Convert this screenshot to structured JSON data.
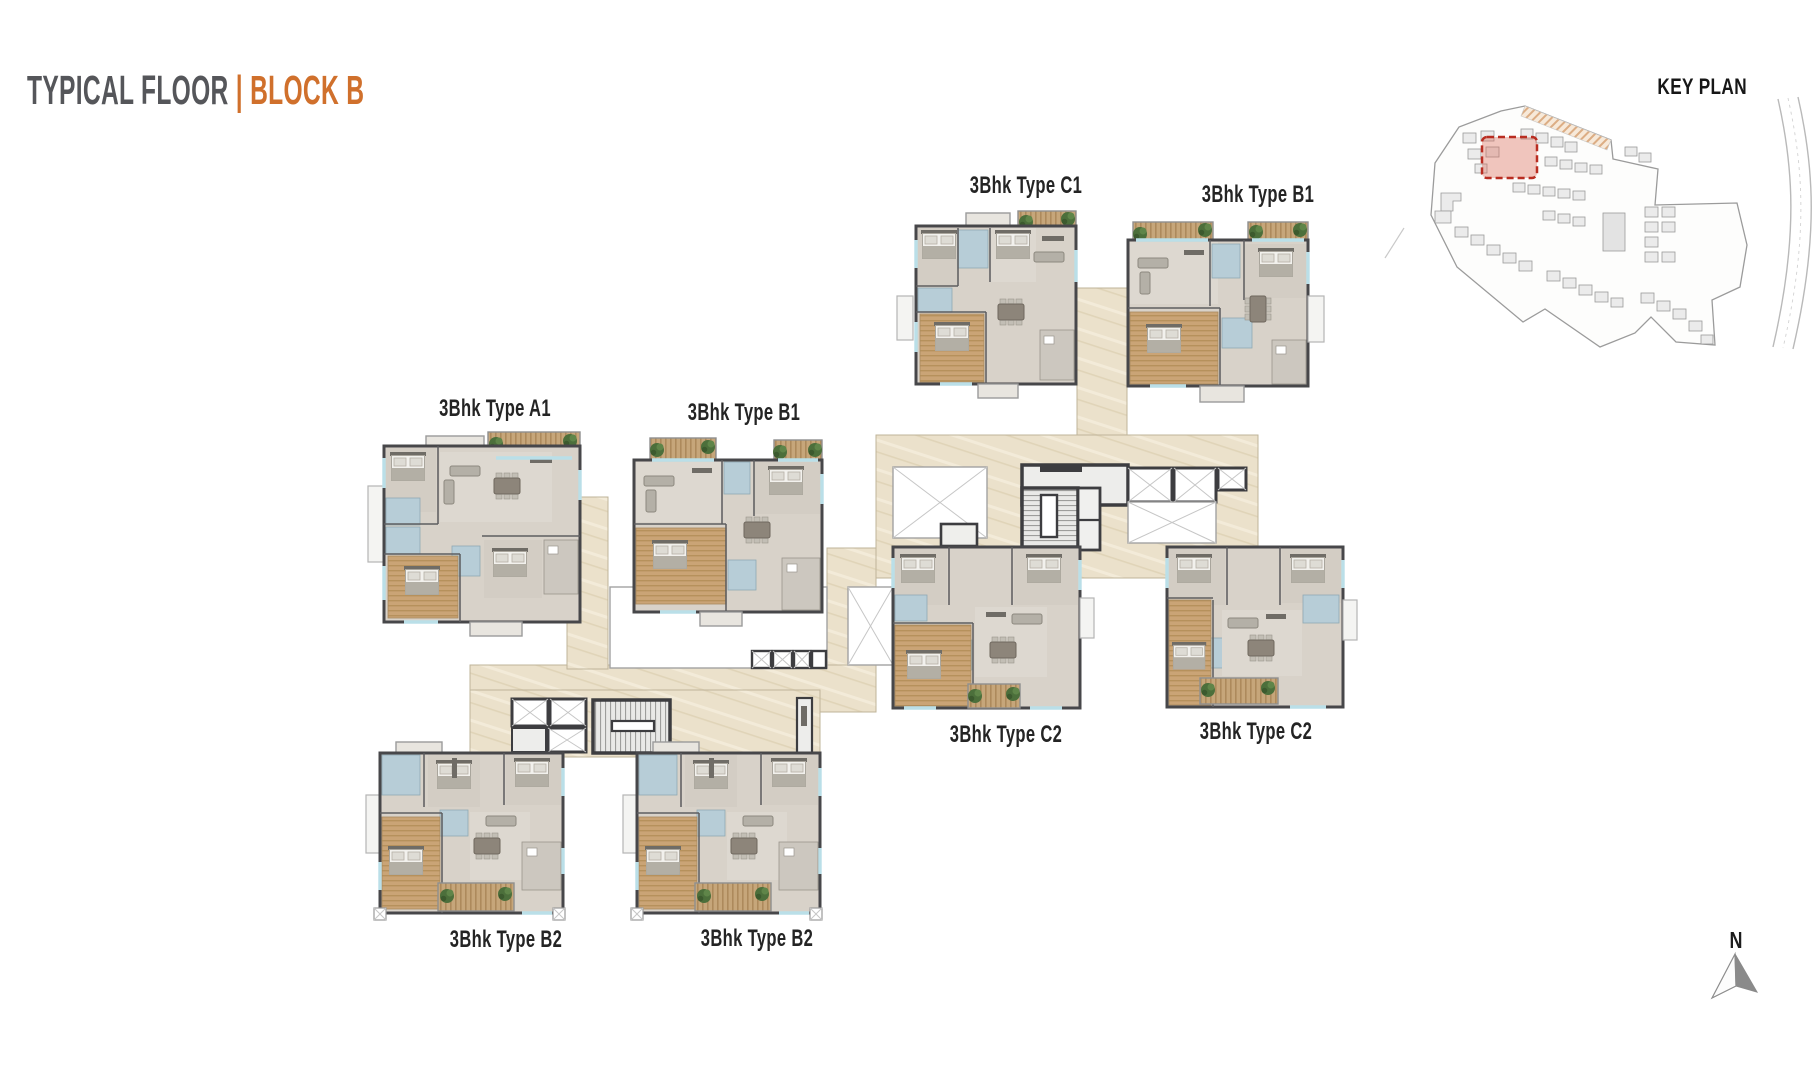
{
  "header": {
    "title_primary": "TYPICAL FLOOR",
    "title_separator": "|",
    "title_accent": "BLOCK B"
  },
  "key_plan": {
    "title": "KEY PLAN"
  },
  "compass": {
    "north_label": "N"
  },
  "units": [
    {
      "id": "c1",
      "label": "3Bhk Type C1"
    },
    {
      "id": "b1-top",
      "label": "3Bhk Type B1"
    },
    {
      "id": "a1",
      "label": "3Bhk Type A1"
    },
    {
      "id": "b1-left",
      "label": "3Bhk Type B1"
    },
    {
      "id": "c2-left",
      "label": "3Bhk Type C2"
    },
    {
      "id": "c2-right",
      "label": "3Bhk Type C2"
    },
    {
      "id": "b2-left",
      "label": "3Bhk Type B2"
    },
    {
      "id": "b2-right",
      "label": "3Bhk Type B2"
    }
  ],
  "colors": {
    "accent_orange": "#d0702c",
    "title_gray": "#55565a",
    "corridor_beige": "#ebe1cc",
    "unit_floor": "#d8d2c9",
    "wall": "#47474a",
    "master_wood": "#c9a476",
    "bathroom_blue": "#b7cdd7",
    "balcony_deck": "#c6a67a",
    "plant_green": "#4c6f3b",
    "keyplan_highlight": "#b92d21"
  }
}
